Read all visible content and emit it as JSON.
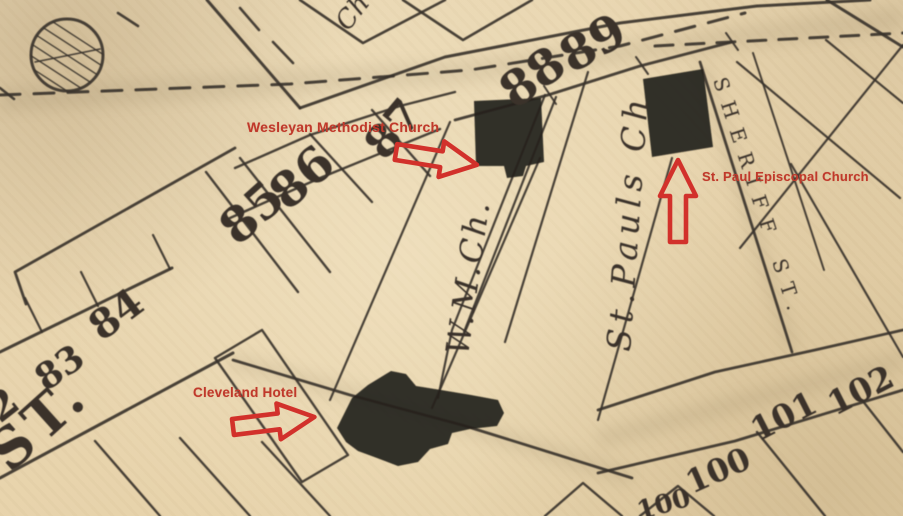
{
  "map": {
    "colors": {
      "paper": "#e8d5b0",
      "ink": "#3a332b",
      "building": "#25211b",
      "annotation_text": "#c0392b",
      "annotation_arrow": "#d2312b"
    },
    "street_labels": {
      "st_abbrev": "ST.",
      "sheriff_street": "SHERIFF ST."
    },
    "building_labels": {
      "church_partial": "Ch",
      "wesleyan_methodist": "W.M.Ch.",
      "st_pauls": "St.Pauls Ch"
    },
    "lot_numbers": {
      "n82_partial": "2",
      "n83": "83",
      "n84": "84",
      "n85": "85",
      "n86": "86",
      "n87": "87",
      "n88": "88",
      "n89": "89",
      "n100": "100",
      "n100_partial": "100",
      "n101": "101",
      "n102": "102"
    },
    "annotations": {
      "wesleyan": {
        "label": "Wesleyan Methodist Church",
        "arrow": "right"
      },
      "st_paul": {
        "label": "St. Paul Episcopal Church",
        "arrow": "up"
      },
      "cleveland": {
        "label": "Cleveland Hotel",
        "arrow": "right"
      }
    }
  }
}
